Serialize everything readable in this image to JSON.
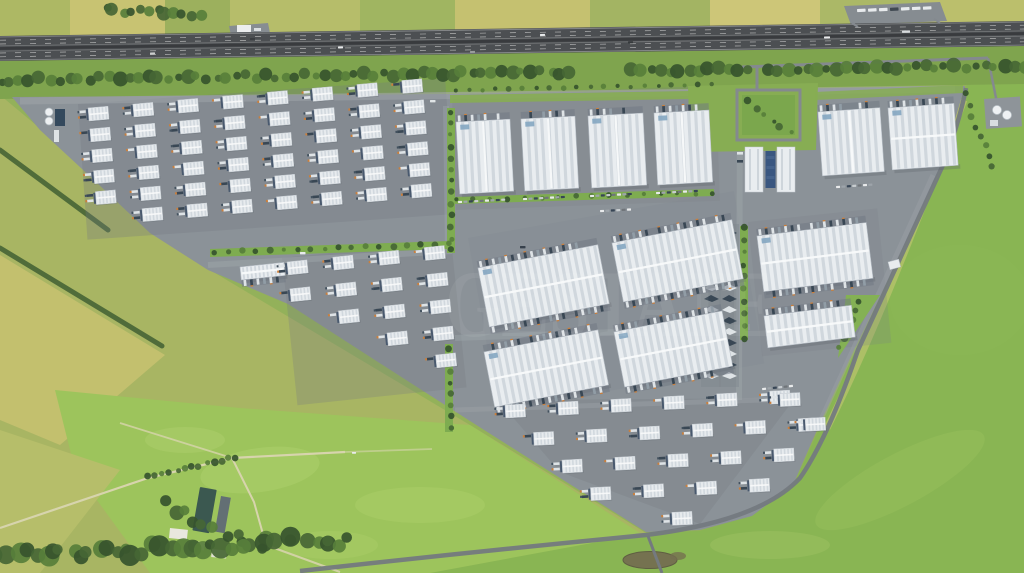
{
  "watermark": {
    "text": "GESTATE",
    "color": "#ffffff",
    "opacity": 0.06
  },
  "palette": {
    "grass_base": "#8fae55",
    "field_yellow": "#c4bf6c",
    "field_lime": "#9ac257",
    "field_green": "#85b24e",
    "tree_dark": "#2f4d26",
    "tree_mid": "#3f612e",
    "tree_light": "#517934",
    "highway_asphalt": "#45484c",
    "lane_mark": "#dcdcdc",
    "verge": "#7aa148",
    "pavement": "#878e95",
    "roof_white": "#e9edf1",
    "roof_rib": "#c8d0d8",
    "roof_ridge": "#f8fafb",
    "roof_vent_blue": "#7fa3c0",
    "dock_dark": "#42536a",
    "trailer_white": "#dde2e7",
    "trailer_dark": "#31404f",
    "cab_orange": "#c97a35",
    "panel_blue": "#31507c",
    "farm_roof": "#33524a",
    "pond": "#6f6a4a"
  },
  "scene": {
    "highway": {
      "top_left": 36,
      "top_right": 21,
      "height": 25,
      "vehicles": [
        {
          "x": 150,
          "y": 52.5,
          "c": "#caccce"
        },
        {
          "x": 338,
          "y": 46.5,
          "c": "#e9ebed"
        },
        {
          "x": 470,
          "y": 51,
          "c": "#96999c"
        },
        {
          "x": 628,
          "y": 41.5,
          "c": "#2e3236"
        },
        {
          "x": 824,
          "y": 36.5,
          "c": "#e9ebed",
          "w": 6
        },
        {
          "x": 902,
          "y": 30.5,
          "c": "#d8dbde",
          "w": 8,
          "h": 2.4
        },
        {
          "x": 540,
          "y": 34,
          "c": "#e9ebed"
        },
        {
          "x": 250,
          "y": 38,
          "c": "#33373b"
        }
      ]
    },
    "tree_rows": [
      {
        "layer": "outer-trees",
        "from": [
          105,
          10
        ],
        "to": [
          200,
          14
        ],
        "count": 12,
        "r": [
          4,
          7
        ],
        "jitter": 6
      },
      {
        "layer": "outer-trees",
        "from": [
          0,
          556
        ],
        "to": [
          350,
          540
        ],
        "count": 40,
        "r": [
          5,
          11
        ],
        "jitter": 12
      },
      {
        "layer": "outer-trees",
        "from": [
          148,
          477
        ],
        "to": [
          236,
          457
        ],
        "count": 13,
        "r": [
          2.5,
          4.5
        ],
        "jitter": 3
      },
      {
        "layer": "outer-trees",
        "from": [
          162,
          505
        ],
        "to": [
          258,
          548
        ],
        "count": 10,
        "r": [
          4,
          8
        ],
        "jitter": 9
      },
      {
        "layer": "verge-trees",
        "from": [
          0,
          80
        ],
        "to": [
          1024,
          66
        ],
        "count": 105,
        "r": [
          3.5,
          7.5
        ],
        "jitter": 5,
        "gaps": [
          [
            578,
            620
          ],
          [
            750,
            768
          ]
        ]
      },
      {
        "layer": "verge-trees",
        "from": [
          965,
          95
        ],
        "to": [
          992,
          168
        ],
        "count": 8,
        "r": [
          2.5,
          4
        ],
        "jitter": 4
      },
      {
        "layer": "site-trees",
        "from": [
          451,
          112
        ],
        "to": [
          451,
          250
        ],
        "count": 13,
        "r": [
          2,
          3.5
        ],
        "jitter": 2
      },
      {
        "layer": "site-trees",
        "from": [
          744,
          228
        ],
        "to": [
          744,
          338
        ],
        "count": 10,
        "r": [
          2,
          3.5
        ],
        "jitter": 2
      },
      {
        "layer": "site-trees",
        "from": [
          215,
          252
        ],
        "to": [
          448,
          244
        ],
        "count": 18,
        "r": [
          2,
          3.5
        ],
        "jitter": 2
      },
      {
        "layer": "site-trees",
        "from": [
          455,
          90
        ],
        "to": [
          712,
          85
        ],
        "count": 20,
        "r": [
          1.8,
          3
        ],
        "jitter": 2
      },
      {
        "layer": "site-trees",
        "from": [
          456,
          200
        ],
        "to": [
          712,
          193
        ],
        "count": 16,
        "r": [
          1.8,
          3
        ],
        "jitter": 2
      },
      {
        "layer": "site-trees",
        "from": [
          449,
          348
        ],
        "to": [
          452,
          428
        ],
        "count": 8,
        "r": [
          2,
          3.5
        ],
        "jitter": 2
      },
      {
        "layer": "site-trees",
        "from": [
          750,
          100
        ],
        "to": [
          790,
          132
        ],
        "count": 6,
        "r": [
          2,
          4
        ],
        "jitter": 6
      },
      {
        "layer": "site-trees",
        "from": [
          860,
          300
        ],
        "to": [
          840,
          348
        ],
        "count": 6,
        "r": [
          2.5,
          4
        ],
        "jitter": 4
      }
    ],
    "herringbone": [
      {
        "x": 704,
        "y": 229,
        "n": 14,
        "step": 11
      },
      {
        "x": 722,
        "y": 229,
        "n": 14,
        "step": 11
      }
    ],
    "large_buildings": [
      {
        "x": 456,
        "y": 122,
        "w": 54,
        "h": 72,
        "rot": -3,
        "docks": "top",
        "vent": true
      },
      {
        "x": 521,
        "y": 119,
        "w": 54,
        "h": 72,
        "rot": -3,
        "docks": "top",
        "vent": true
      },
      {
        "x": 588,
        "y": 116,
        "w": 55,
        "h": 72,
        "rot": -3,
        "docks": "top",
        "vent": true
      },
      {
        "x": 654,
        "y": 113,
        "w": 55,
        "h": 72,
        "rot": -3,
        "docks": "top",
        "vent": true
      },
      {
        "x": 818,
        "y": 112,
        "w": 62,
        "h": 64,
        "rot": -4,
        "docks": "top",
        "vent": true
      },
      {
        "x": 888,
        "y": 108,
        "w": 66,
        "h": 62,
        "rot": -4,
        "docks": "top",
        "vent": true
      },
      {
        "x": 478,
        "y": 268,
        "w": 122,
        "h": 60,
        "rot": -11,
        "docks": "both",
        "vent": true
      },
      {
        "x": 612,
        "y": 243,
        "w": 122,
        "h": 60,
        "rot": -11,
        "docks": "both",
        "vent": true
      },
      {
        "x": 757,
        "y": 236,
        "w": 110,
        "h": 56,
        "rot": -7,
        "docks": "both",
        "vent": true
      },
      {
        "x": 764,
        "y": 316,
        "w": 88,
        "h": 32,
        "rot": -7,
        "docks": "top"
      },
      {
        "x": 484,
        "y": 352,
        "w": 116,
        "h": 56,
        "rot": -11,
        "docks": "both",
        "vent": true
      },
      {
        "x": 614,
        "y": 332,
        "w": 110,
        "h": 56,
        "rot": -11,
        "docks": "both",
        "vent": true
      },
      {
        "x": 240,
        "y": 267,
        "w": 44,
        "h": 13,
        "rot": -6,
        "docks": "bottom",
        "ribStep": 4
      }
    ],
    "unit_clusters": [
      {
        "x": 88,
        "y": 108,
        "cols": 8,
        "rows": 6,
        "dx": 45,
        "dy": 21,
        "rot": -5,
        "startCols": [
          0,
          0,
          0,
          0,
          0,
          1
        ]
      },
      {
        "x": 287,
        "y": 262,
        "cols": 4,
        "rows": 5,
        "dx": 46,
        "dy": 27,
        "rot": -6,
        "startCols": [
          0,
          0,
          1,
          2,
          3
        ]
      },
      {
        "x": 505,
        "y": 405,
        "cols": 6,
        "rows": 5,
        "dx": 53,
        "dy": 29,
        "rot": -3,
        "rowShift": 27,
        "startCols": [
          0,
          0,
          0,
          0,
          1
        ],
        "skips": [
          [
            2,
            5
          ],
          [
            3,
            4
          ],
          [
            3,
            5
          ],
          [
            4,
            2
          ],
          [
            4,
            3
          ],
          [
            4,
            4
          ],
          [
            4,
            5
          ]
        ],
        "extras": [
          [
            780,
            408
          ],
          [
            804,
            434
          ]
        ]
      }
    ],
    "car_rows": [
      {
        "x": 458,
        "y": 201,
        "n": 9,
        "rot": -3
      },
      {
        "x": 523,
        "y": 198,
        "n": 8,
        "rot": -3
      },
      {
        "x": 590,
        "y": 195,
        "n": 8,
        "rot": -3
      },
      {
        "x": 656,
        "y": 192,
        "n": 8,
        "rot": -3
      },
      {
        "x": 836,
        "y": 186,
        "n": 7,
        "rot": -4
      },
      {
        "x": 762,
        "y": 388,
        "n": 6,
        "rot": -6
      },
      {
        "x": 600,
        "y": 210,
        "n": 6,
        "rot": -3
      }
    ],
    "road_vehicles": [
      {
        "x": 300,
        "y": 252,
        "c": "#e8ebee"
      },
      {
        "x": 430,
        "y": 100,
        "c": "#dfe3e6"
      },
      {
        "x": 520,
        "y": 246,
        "c": "#2f3a46"
      },
      {
        "x": 352,
        "y": 452,
        "c": "#e8ebee",
        "w": 4,
        "h": 1.8
      },
      {
        "x": 748,
        "y": 160,
        "c": "#e8ebee"
      }
    ],
    "rest_area_trucks": {
      "x": 857,
      "y": 9,
      "n": 7,
      "dx": 11
    }
  }
}
